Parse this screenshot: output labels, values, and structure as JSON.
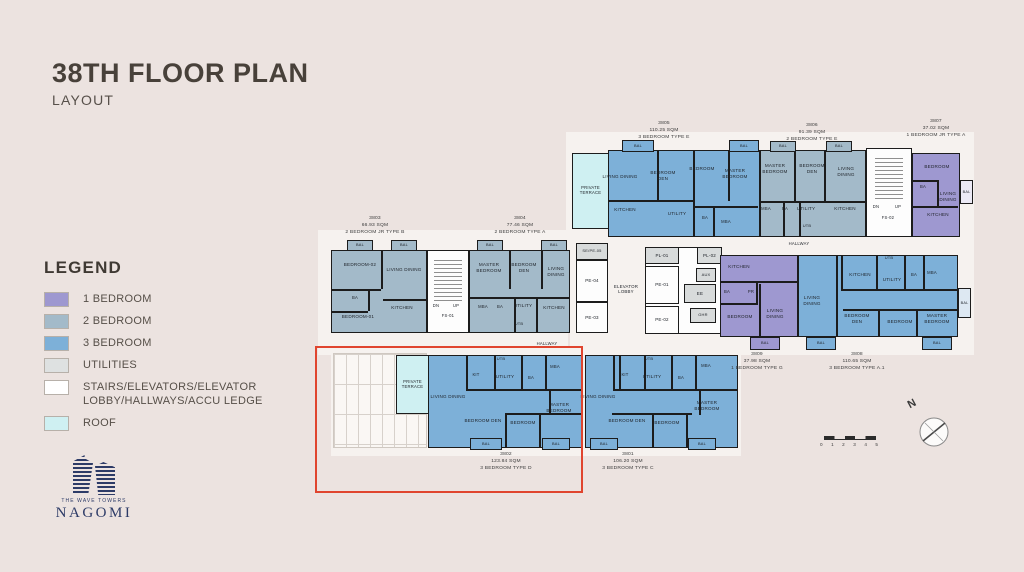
{
  "title": {
    "main": "38TH FLOOR PLAN",
    "sub": "LAYOUT"
  },
  "legend": {
    "heading": "LEGEND",
    "items": [
      {
        "label": "1 BEDROOM",
        "color": "#9e98d0"
      },
      {
        "label": "2 BEDROOM",
        "color": "#a3bac9"
      },
      {
        "label": "3 BEDROOM",
        "color": "#7db0d8"
      },
      {
        "label": "UTILITIES",
        "color": "#dee1e1"
      },
      {
        "label": "STAIRS/ELEVATORS/ELEVATOR LOBBY/HALLWAYS/ACCU LEDGE",
        "color": "#ffffff"
      },
      {
        "label": "ROOF",
        "color": "#cff0f2"
      }
    ]
  },
  "logo": {
    "tagline": "THE WAVE TOWERS",
    "name": "NAGOMI"
  },
  "compass": {
    "label": "N"
  },
  "scale_bar": {
    "ticks": [
      "0",
      "1",
      "2",
      "3",
      "4",
      "5"
    ]
  },
  "colors": {
    "background": "#ece3e0",
    "highlight": "#e0452f",
    "wall": "#1c1c1c",
    "one_bed": "#9e98d0",
    "two_bed": "#a3bac9",
    "three_bed": "#7db0d8",
    "utilities": "#dee1e1",
    "roof": "#cff0f2",
    "stairs": "#fdfdfd"
  },
  "plan": {
    "balcony_label": "BAL",
    "rects": [
      {
        "n": "hallway-backdrop-top",
        "x": 566,
        "y": 132,
        "w": 408,
        "h": 123,
        "f": "#f6f2ef"
      },
      {
        "n": "hallway-backdrop-left",
        "x": 318,
        "y": 230,
        "w": 250,
        "h": 125,
        "f": "#f6f2ef"
      },
      {
        "n": "hallway-backdrop-mid",
        "x": 570,
        "y": 238,
        "w": 404,
        "h": 117,
        "f": "#f6f2ef"
      },
      {
        "n": "hallway-backdrop-bottom",
        "x": 331,
        "y": 346,
        "w": 410,
        "h": 110,
        "f": "#f6f2ef"
      },
      {
        "n": "accu-ledge-grid",
        "x": 333,
        "y": 353,
        "w": 94,
        "h": 95,
        "cls": "grid"
      },
      {
        "n": "terrace-3805",
        "x": 572,
        "y": 153,
        "w": 37,
        "h": 76,
        "f": "#cff0f2",
        "b": 1,
        "label": "PRIVATE TERRACE",
        "fs": 4.2
      },
      {
        "n": "unit-3805",
        "x": 608,
        "y": 150,
        "w": 152,
        "h": 87,
        "f": "#7db0d8",
        "b": 1
      },
      {
        "n": "unit-3806",
        "x": 760,
        "y": 150,
        "w": 106,
        "h": 87,
        "f": "#a3bac9",
        "b": 1
      },
      {
        "n": "stairs-fs02",
        "x": 866,
        "y": 148,
        "w": 46,
        "h": 89,
        "f": "#fdfdfd",
        "b": 1
      },
      {
        "n": "stair-steps-fs02",
        "x": 875,
        "y": 158,
        "w": 28,
        "h": 44,
        "cls": "stairs"
      },
      {
        "n": "unit-3807",
        "x": 912,
        "y": 153,
        "w": 48,
        "h": 84,
        "f": "#9e98d0",
        "b": 1
      },
      {
        "n": "balcony-3807-side",
        "x": 960,
        "y": 180,
        "w": 13,
        "h": 24,
        "f": "#eceaf6",
        "b": 1,
        "label": "BAL",
        "fs": 3.8
      },
      {
        "n": "unit-3803",
        "x": 331,
        "y": 250,
        "w": 96,
        "h": 83,
        "f": "#a3bac9",
        "b": 1
      },
      {
        "n": "stairs-fs01",
        "x": 427,
        "y": 250,
        "w": 42,
        "h": 83,
        "f": "#fdfdfd",
        "b": 1
      },
      {
        "n": "stair-steps-fs01",
        "x": 434,
        "y": 260,
        "w": 28,
        "h": 42,
        "cls": "stairs"
      },
      {
        "n": "unit-3804",
        "x": 469,
        "y": 250,
        "w": 101,
        "h": 83,
        "f": "#a3bac9",
        "b": 1
      },
      {
        "n": "core-shaft-left",
        "x": 576,
        "y": 243,
        "w": 32,
        "h": 90,
        "f": "#fdfdfd",
        "b": 1
      },
      {
        "n": "room-se-pe-05",
        "x": 576,
        "y": 243,
        "w": 32,
        "h": 17,
        "f": "#d8dbdb",
        "b": 1,
        "label": "SE/PE-05",
        "fs": 4
      },
      {
        "n": "room-pe-04",
        "x": 576,
        "y": 260,
        "w": 32,
        "h": 42,
        "f": "#fdfdfd",
        "b": 1,
        "label": "PE-04",
        "fs": 4.5
      },
      {
        "n": "room-pe-03",
        "x": 576,
        "y": 302,
        "w": 32,
        "h": 31,
        "f": "#fdfdfd",
        "b": 1,
        "label": "PE-03",
        "fs": 4.5
      },
      {
        "n": "core-shaft-right",
        "x": 645,
        "y": 247,
        "w": 77,
        "h": 87,
        "f": "#fdfdfd",
        "b": 1
      },
      {
        "n": "room-pl-01",
        "x": 645,
        "y": 247,
        "w": 34,
        "h": 17,
        "f": "#d8dbdb",
        "b": 1,
        "label": "PL-01",
        "fs": 4.5
      },
      {
        "n": "room-pl-02",
        "x": 697,
        "y": 247,
        "w": 25,
        "h": 17,
        "f": "#d8dbdb",
        "b": 1,
        "label": "PL-02",
        "fs": 4.5
      },
      {
        "n": "room-pe-01",
        "x": 645,
        "y": 266,
        "w": 34,
        "h": 38,
        "f": "#fdfdfd",
        "b": 1,
        "label": "PE-01",
        "fs": 4.5
      },
      {
        "n": "room-pe-02",
        "x": 645,
        "y": 306,
        "w": 34,
        "h": 28,
        "f": "#fdfdfd",
        "b": 1,
        "label": "PE-02",
        "fs": 4.5
      },
      {
        "n": "room-aux",
        "x": 696,
        "y": 268,
        "w": 20,
        "h": 14,
        "f": "#d8dbdb",
        "b": 1,
        "label": "AUX",
        "fs": 4
      },
      {
        "n": "room-ee",
        "x": 684,
        "y": 284,
        "w": 32,
        "h": 19,
        "f": "#d8dbdb",
        "b": 1,
        "label": "EE",
        "fs": 4.5
      },
      {
        "n": "room-ghr",
        "x": 690,
        "y": 308,
        "w": 26,
        "h": 15,
        "f": "#d8dbdb",
        "b": 1,
        "label": "GHR",
        "fs": 4
      },
      {
        "n": "unit-3809",
        "x": 720,
        "y": 255,
        "w": 78,
        "h": 82,
        "f": "#9e98d0",
        "b": 1
      },
      {
        "n": "unit-3808",
        "x": 798,
        "y": 255,
        "w": 160,
        "h": 82,
        "f": "#7db0d8",
        "b": 1
      },
      {
        "n": "balcony-3808-side",
        "x": 958,
        "y": 288,
        "w": 13,
        "h": 30,
        "f": "#dde8f2",
        "b": 1,
        "label": "BAL",
        "fs": 3.8
      },
      {
        "n": "terrace-3802",
        "x": 396,
        "y": 355,
        "w": 33,
        "h": 59,
        "f": "#cff0f2",
        "b": 1,
        "label": "PRIVATE TERRACE",
        "fs": 4.2
      },
      {
        "n": "unit-3802",
        "x": 428,
        "y": 355,
        "w": 155,
        "h": 93,
        "f": "#7db0d8",
        "b": 1
      },
      {
        "n": "unit-3801",
        "x": 585,
        "y": 355,
        "w": 153,
        "h": 93,
        "f": "#7db0d8",
        "b": 1
      }
    ],
    "walls": [
      [
        657,
        151,
        2,
        50
      ],
      [
        693,
        151,
        2,
        85
      ],
      [
        728,
        151,
        2,
        50
      ],
      [
        609,
        200,
        84,
        2
      ],
      [
        695,
        206,
        63,
        2
      ],
      [
        713,
        208,
        2,
        28
      ],
      [
        794,
        151,
        2,
        50
      ],
      [
        824,
        151,
        2,
        50
      ],
      [
        761,
        201,
        104,
        2
      ],
      [
        783,
        203,
        2,
        33
      ],
      [
        799,
        203,
        2,
        33
      ],
      [
        913,
        180,
        26,
        2
      ],
      [
        937,
        182,
        2,
        24
      ],
      [
        913,
        206,
        45,
        2
      ],
      [
        381,
        251,
        2,
        38
      ],
      [
        332,
        289,
        49,
        2
      ],
      [
        368,
        291,
        2,
        20
      ],
      [
        383,
        299,
        44,
        2
      ],
      [
        332,
        311,
        36,
        2
      ],
      [
        509,
        251,
        2,
        38
      ],
      [
        541,
        251,
        2,
        38
      ],
      [
        470,
        297,
        99,
        2
      ],
      [
        514,
        299,
        2,
        33
      ],
      [
        536,
        299,
        2,
        33
      ],
      [
        721,
        281,
        76,
        2
      ],
      [
        756,
        283,
        2,
        21
      ],
      [
        721,
        303,
        37,
        2
      ],
      [
        759,
        284,
        2,
        52
      ],
      [
        841,
        256,
        2,
        33
      ],
      [
        876,
        256,
        2,
        33
      ],
      [
        904,
        256,
        2,
        33
      ],
      [
        923,
        256,
        2,
        33
      ],
      [
        841,
        289,
        116,
        2
      ],
      [
        836,
        256,
        2,
        81
      ],
      [
        843,
        309,
        114,
        2
      ],
      [
        878,
        311,
        2,
        26
      ],
      [
        916,
        311,
        2,
        26
      ],
      [
        466,
        356,
        2,
        33
      ],
      [
        494,
        356,
        2,
        33
      ],
      [
        521,
        356,
        2,
        33
      ],
      [
        545,
        356,
        2,
        33
      ],
      [
        466,
        389,
        116,
        2
      ],
      [
        549,
        391,
        2,
        24
      ],
      [
        505,
        413,
        77,
        2
      ],
      [
        505,
        415,
        2,
        32
      ],
      [
        539,
        415,
        2,
        32
      ],
      [
        619,
        356,
        2,
        33
      ],
      [
        644,
        356,
        2,
        33
      ],
      [
        671,
        356,
        2,
        33
      ],
      [
        695,
        356,
        2,
        33
      ],
      [
        614,
        389,
        123,
        2
      ],
      [
        699,
        391,
        2,
        24
      ],
      [
        612,
        413,
        80,
        2
      ],
      [
        652,
        415,
        2,
        32
      ],
      [
        686,
        415,
        2,
        32
      ],
      [
        613,
        356,
        2,
        35
      ]
    ],
    "balconies": [
      [
        622,
        140,
        32,
        12,
        "#7db0d8"
      ],
      [
        729,
        140,
        30,
        12,
        "#7db0d8"
      ],
      [
        770,
        141,
        26,
        11,
        "#a3bac9"
      ],
      [
        826,
        141,
        26,
        11,
        "#a3bac9"
      ],
      [
        347,
        240,
        26,
        11,
        "#a3bac9"
      ],
      [
        391,
        240,
        26,
        11,
        "#a3bac9"
      ],
      [
        477,
        240,
        26,
        11,
        "#a3bac9"
      ],
      [
        541,
        240,
        26,
        11,
        "#a3bac9"
      ],
      [
        750,
        337,
        30,
        13,
        "#9e98d0"
      ],
      [
        806,
        337,
        30,
        13,
        "#7db0d8"
      ],
      [
        922,
        337,
        30,
        13,
        "#7db0d8"
      ],
      [
        470,
        438,
        32,
        12,
        "#7db0d8"
      ],
      [
        542,
        438,
        28,
        12,
        "#7db0d8"
      ],
      [
        590,
        438,
        28,
        12,
        "#7db0d8"
      ],
      [
        688,
        438,
        28,
        12,
        "#7db0d8"
      ]
    ],
    "room_labels": [
      [
        602,
        174,
        36,
        "LIVING DINING"
      ],
      [
        645,
        170,
        36,
        "BEDROOM DEN"
      ],
      [
        682,
        166,
        40,
        "BEDROOM"
      ],
      [
        714,
        168,
        42,
        "MASTER BEDROOM"
      ],
      [
        607,
        207,
        36,
        "KITCHEN"
      ],
      [
        660,
        211,
        34,
        "UTILITY"
      ],
      [
        696,
        215,
        18,
        "BA",
        4.2
      ],
      [
        716,
        219,
        20,
        "MBA",
        4.2
      ],
      [
        757,
        163,
        36,
        "MASTER BEDROOM"
      ],
      [
        795,
        163,
        34,
        "BEDROOM DEN"
      ],
      [
        829,
        166,
        34,
        "LIVING DINING"
      ],
      [
        756,
        206,
        20,
        "MBA",
        4.2
      ],
      [
        777,
        206,
        16,
        "BA",
        4.2
      ],
      [
        791,
        206,
        30,
        "UTILITY"
      ],
      [
        797,
        224,
        20,
        "UTB",
        4
      ],
      [
        829,
        206,
        32,
        "KITCHEN"
      ],
      [
        868,
        204,
        16,
        "DN",
        4.2
      ],
      [
        890,
        204,
        16,
        "UP",
        4.2
      ],
      [
        874,
        215,
        28,
        "FS-02",
        4.2
      ],
      [
        920,
        164,
        34,
        "BEDROOM"
      ],
      [
        915,
        184,
        16,
        "BA",
        4.2
      ],
      [
        933,
        191,
        30,
        "LIVING DINING"
      ],
      [
        921,
        212,
        34,
        "KITCHEN"
      ],
      [
        779,
        241,
        40,
        "HALLWAY",
        4.2
      ],
      [
        526,
        341,
        42,
        "HALLWAY",
        4.2
      ],
      [
        339,
        262,
        42,
        "BEDROOM-02"
      ],
      [
        386,
        267,
        36,
        "LIVING DINING"
      ],
      [
        346,
        295,
        18,
        "BA",
        4.2
      ],
      [
        337,
        314,
        42,
        "BEDROOM-01"
      ],
      [
        386,
        305,
        32,
        "KITCHEN"
      ],
      [
        428,
        303,
        16,
        "DN",
        4.2
      ],
      [
        448,
        303,
        16,
        "UP",
        4.2
      ],
      [
        434,
        313,
        28,
        "FS-01",
        4.2
      ],
      [
        470,
        262,
        38,
        "MASTER BEDROOM"
      ],
      [
        507,
        262,
        34,
        "BEDROOM DEN"
      ],
      [
        539,
        266,
        34,
        "LIVING DINING"
      ],
      [
        473,
        304,
        20,
        "MBA",
        4.2
      ],
      [
        492,
        304,
        16,
        "BA",
        4.2
      ],
      [
        509,
        303,
        28,
        "UTILITY"
      ],
      [
        509,
        322,
        20,
        "UTB",
        4
      ],
      [
        539,
        305,
        30,
        "KITCHEN"
      ],
      [
        607,
        284,
        38,
        "ELEVATOR LOBBY",
        4.4
      ],
      [
        724,
        264,
        30,
        "KITCHEN"
      ],
      [
        720,
        289,
        14,
        "BA",
        4.2
      ],
      [
        744,
        289,
        14,
        "PR",
        4.2
      ],
      [
        723,
        314,
        34,
        "BEDROOM"
      ],
      [
        761,
        308,
        28,
        "LIVING DINING"
      ],
      [
        795,
        295,
        34,
        "LIVING DINING"
      ],
      [
        844,
        272,
        32,
        "KITCHEN"
      ],
      [
        880,
        256,
        18,
        "UTB",
        4
      ],
      [
        877,
        277,
        30,
        "UTILITY"
      ],
      [
        907,
        272,
        14,
        "BA",
        4.2
      ],
      [
        922,
        270,
        20,
        "MBA",
        4.2
      ],
      [
        839,
        313,
        36,
        "BEDROOM DEN"
      ],
      [
        883,
        319,
        34,
        "BEDROOM"
      ],
      [
        918,
        313,
        38,
        "MASTER BEDROOM"
      ],
      [
        466,
        372,
        20,
        "KIT",
        4.2
      ],
      [
        491,
        357,
        20,
        "UTB",
        4
      ],
      [
        490,
        374,
        30,
        "UTILITY"
      ],
      [
        523,
        375,
        16,
        "BA",
        4.2
      ],
      [
        545,
        364,
        20,
        "MBA",
        4.2
      ],
      [
        430,
        394,
        36,
        "LIVING DINING"
      ],
      [
        464,
        418,
        38,
        "BEDROOM DEN"
      ],
      [
        506,
        420,
        34,
        "BEDROOM"
      ],
      [
        540,
        402,
        38,
        "MASTER BEDROOM"
      ],
      [
        580,
        394,
        36,
        "LIVING DINING"
      ],
      [
        615,
        372,
        20,
        "KIT",
        4.2
      ],
      [
        639,
        357,
        20,
        "UTB",
        4
      ],
      [
        637,
        374,
        30,
        "UTILITY"
      ],
      [
        673,
        375,
        16,
        "BA",
        4.2
      ],
      [
        696,
        363,
        20,
        "MBA",
        4.2
      ],
      [
        608,
        418,
        38,
        "BEDROOM DEN"
      ],
      [
        650,
        420,
        34,
        "BEDROOM"
      ],
      [
        688,
        400,
        38,
        "MASTER BEDROOM"
      ]
    ],
    "captions": [
      {
        "n": "caption-3805",
        "x": 609,
        "y": 121,
        "lines": [
          "3805",
          "110.25 SQM",
          "3 BEDROOM TYPE E"
        ]
      },
      {
        "n": "caption-3806",
        "x": 757,
        "y": 123,
        "lines": [
          "3806",
          "91.39 SQM",
          "2 BEDROOM TYPE E"
        ]
      },
      {
        "n": "caption-3807",
        "x": 881,
        "y": 119,
        "lines": [
          "3807",
          "37.02 SQM",
          "1 BEDROOM JR TYPE A"
        ]
      },
      {
        "n": "caption-3803",
        "x": 320,
        "y": 216,
        "lines": [
          "3803",
          "66.93 SQM",
          "2 BEDROOM JR TYPE B"
        ]
      },
      {
        "n": "caption-3804",
        "x": 465,
        "y": 216,
        "lines": [
          "3804",
          "77.46 SQM",
          "2 BEDROOM TYPE A"
        ]
      },
      {
        "n": "caption-3809",
        "x": 702,
        "y": 352,
        "lines": [
          "3809",
          "37.98 SQM",
          "1 BEDROOM TYPE G"
        ]
      },
      {
        "n": "caption-3808",
        "x": 802,
        "y": 352,
        "lines": [
          "3808",
          "110.65 SQM",
          "3 BEDROOM TYPE A.1"
        ]
      },
      {
        "n": "caption-3802",
        "x": 451,
        "y": 452,
        "lines": [
          "3802",
          "123.84 SQM",
          "3 BEDROOM TYPE D"
        ]
      },
      {
        "n": "caption-3801",
        "x": 573,
        "y": 452,
        "lines": [
          "3801",
          "106.20 SQM",
          "3 BEDROOM TYPE C"
        ]
      }
    ],
    "highlight": {
      "x": 315,
      "y": 346,
      "w": 268,
      "h": 147,
      "color": "#e0452f"
    }
  }
}
